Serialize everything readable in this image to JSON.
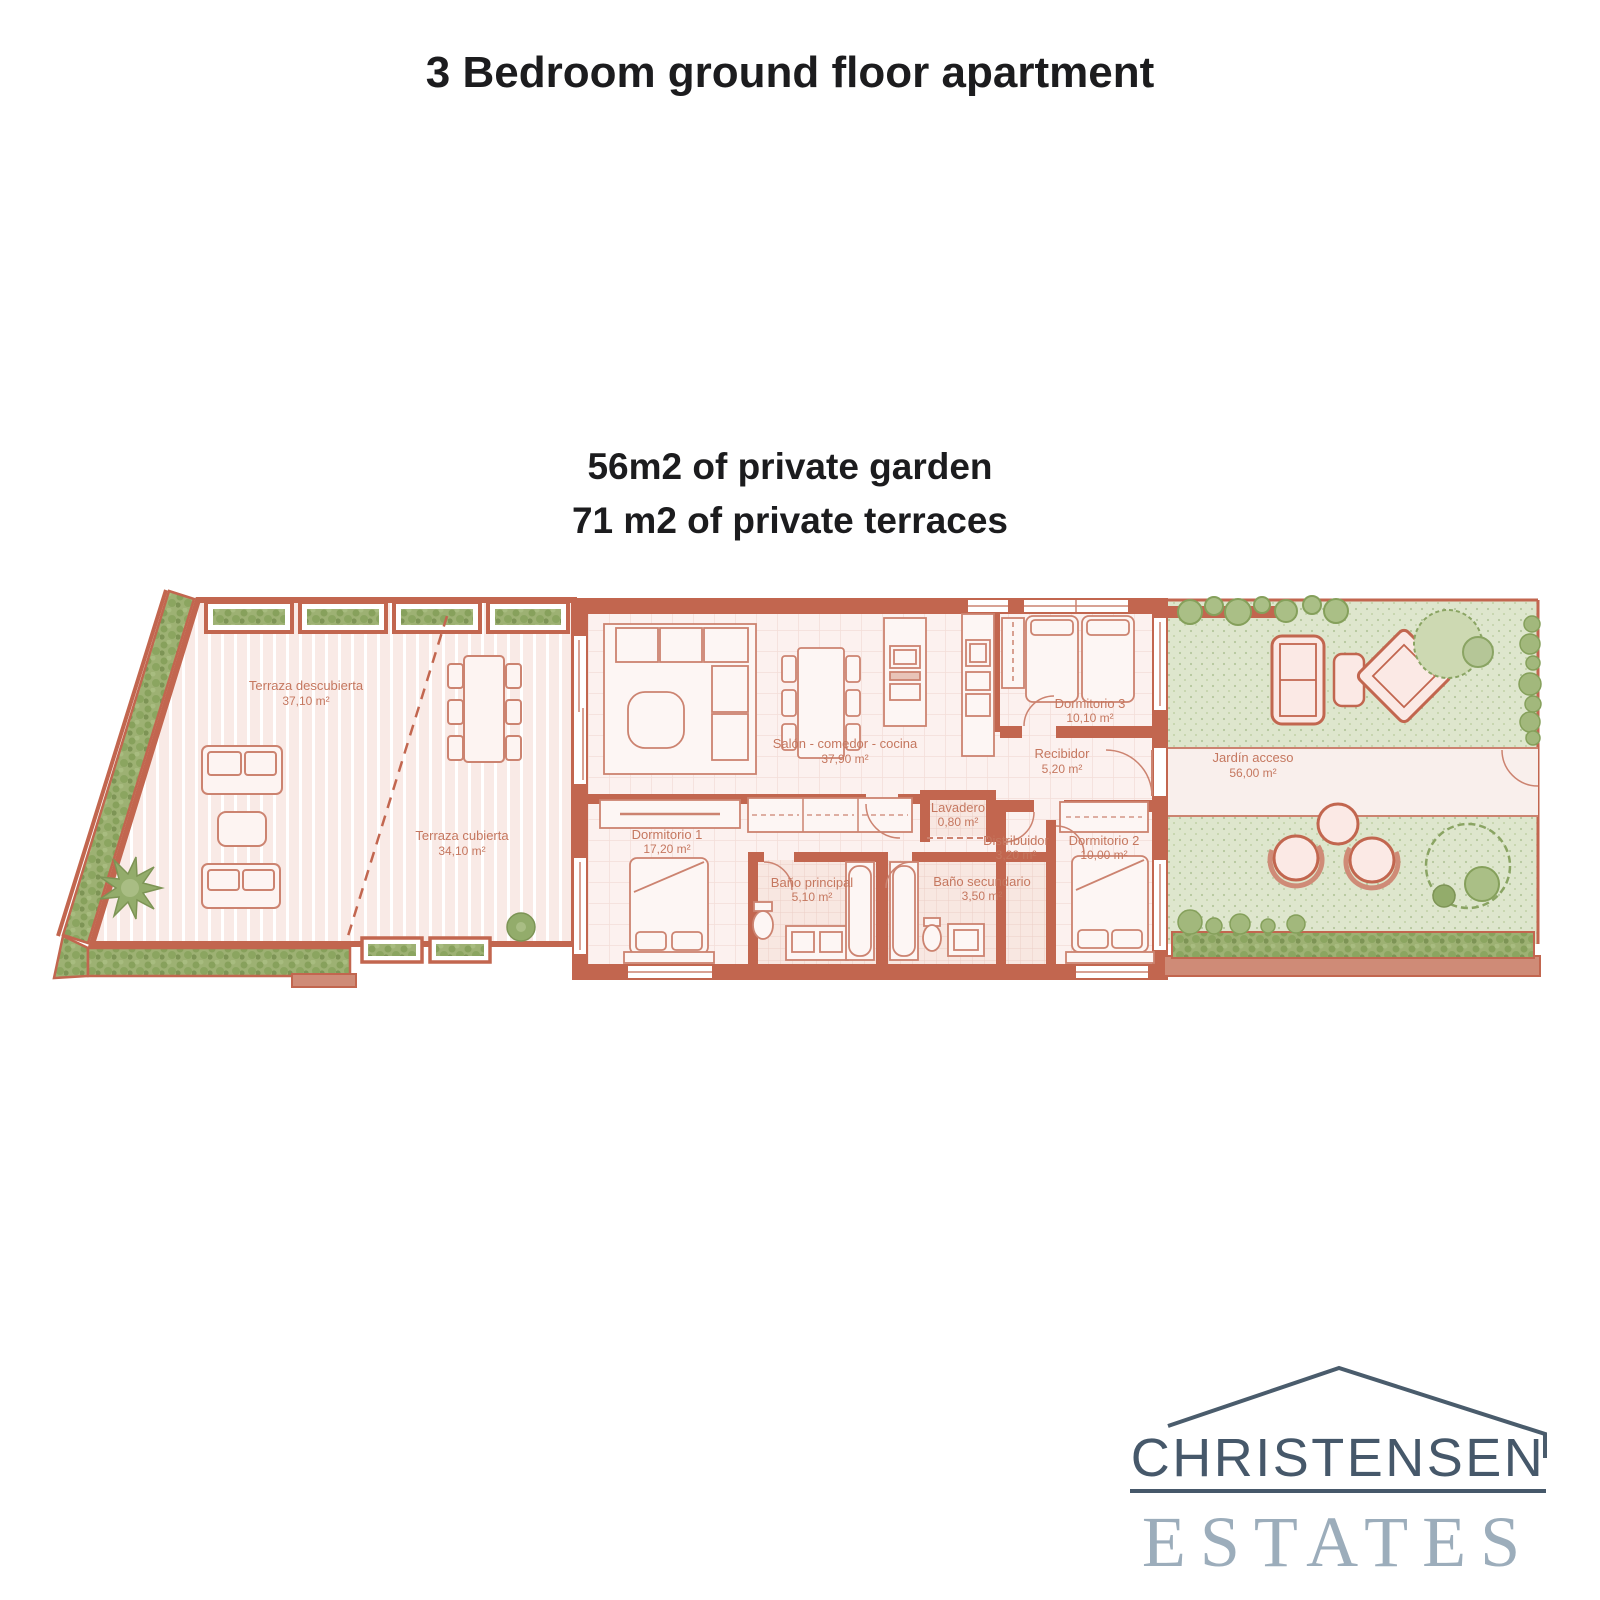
{
  "header": {
    "title": "3 Bedroom ground floor apartment"
  },
  "summary": {
    "line1": "56m2 of private garden",
    "line2": "71 m2 of private terraces"
  },
  "floorplan": {
    "rooms": {
      "terraza_descubierta": {
        "name": "Terraza descubierta",
        "area": "37,10 m²"
      },
      "terraza_cubierta": {
        "name": "Terraza cubierta",
        "area": "34,10 m²"
      },
      "salon": {
        "name": "Salón - comedor - cocina",
        "area": "37,90 m²"
      },
      "dormitorio3": {
        "name": "Dormitorio 3",
        "area": "10,10 m²"
      },
      "recibidor": {
        "name": "Recibidor",
        "area": "5,20 m²"
      },
      "jardin": {
        "name": "Jardín acceso",
        "area": "56,00 m²"
      },
      "dormitorio1": {
        "name": "Dormitorio 1",
        "area": "17,20 m²"
      },
      "lavadero": {
        "name": "Lavadero",
        "area": "0,80 m²"
      },
      "distribuidor": {
        "name": "Distribuidor",
        "area": "3,20 m²"
      },
      "dormitorio2": {
        "name": "Dormitorio 2",
        "area": "10,00 m²"
      },
      "bano_principal": {
        "name": "Baño principal",
        "area": "5,10 m²"
      },
      "bano_secundario": {
        "name": "Baño secundario",
        "area": "3,50 m²"
      }
    }
  },
  "logo": {
    "brand": "CHRISTENSEN",
    "division": "ESTATES"
  },
  "colors": {
    "wall": "#c2664f",
    "floor": "#fbf0ee",
    "terrace_floor": "#f9eae6",
    "hedge": "#9db173",
    "garden": "#dee6cd",
    "room_label": "#c5775f",
    "logo_dark": "#46586a",
    "logo_light": "#9cadbb",
    "text": "#1c1c1e"
  }
}
